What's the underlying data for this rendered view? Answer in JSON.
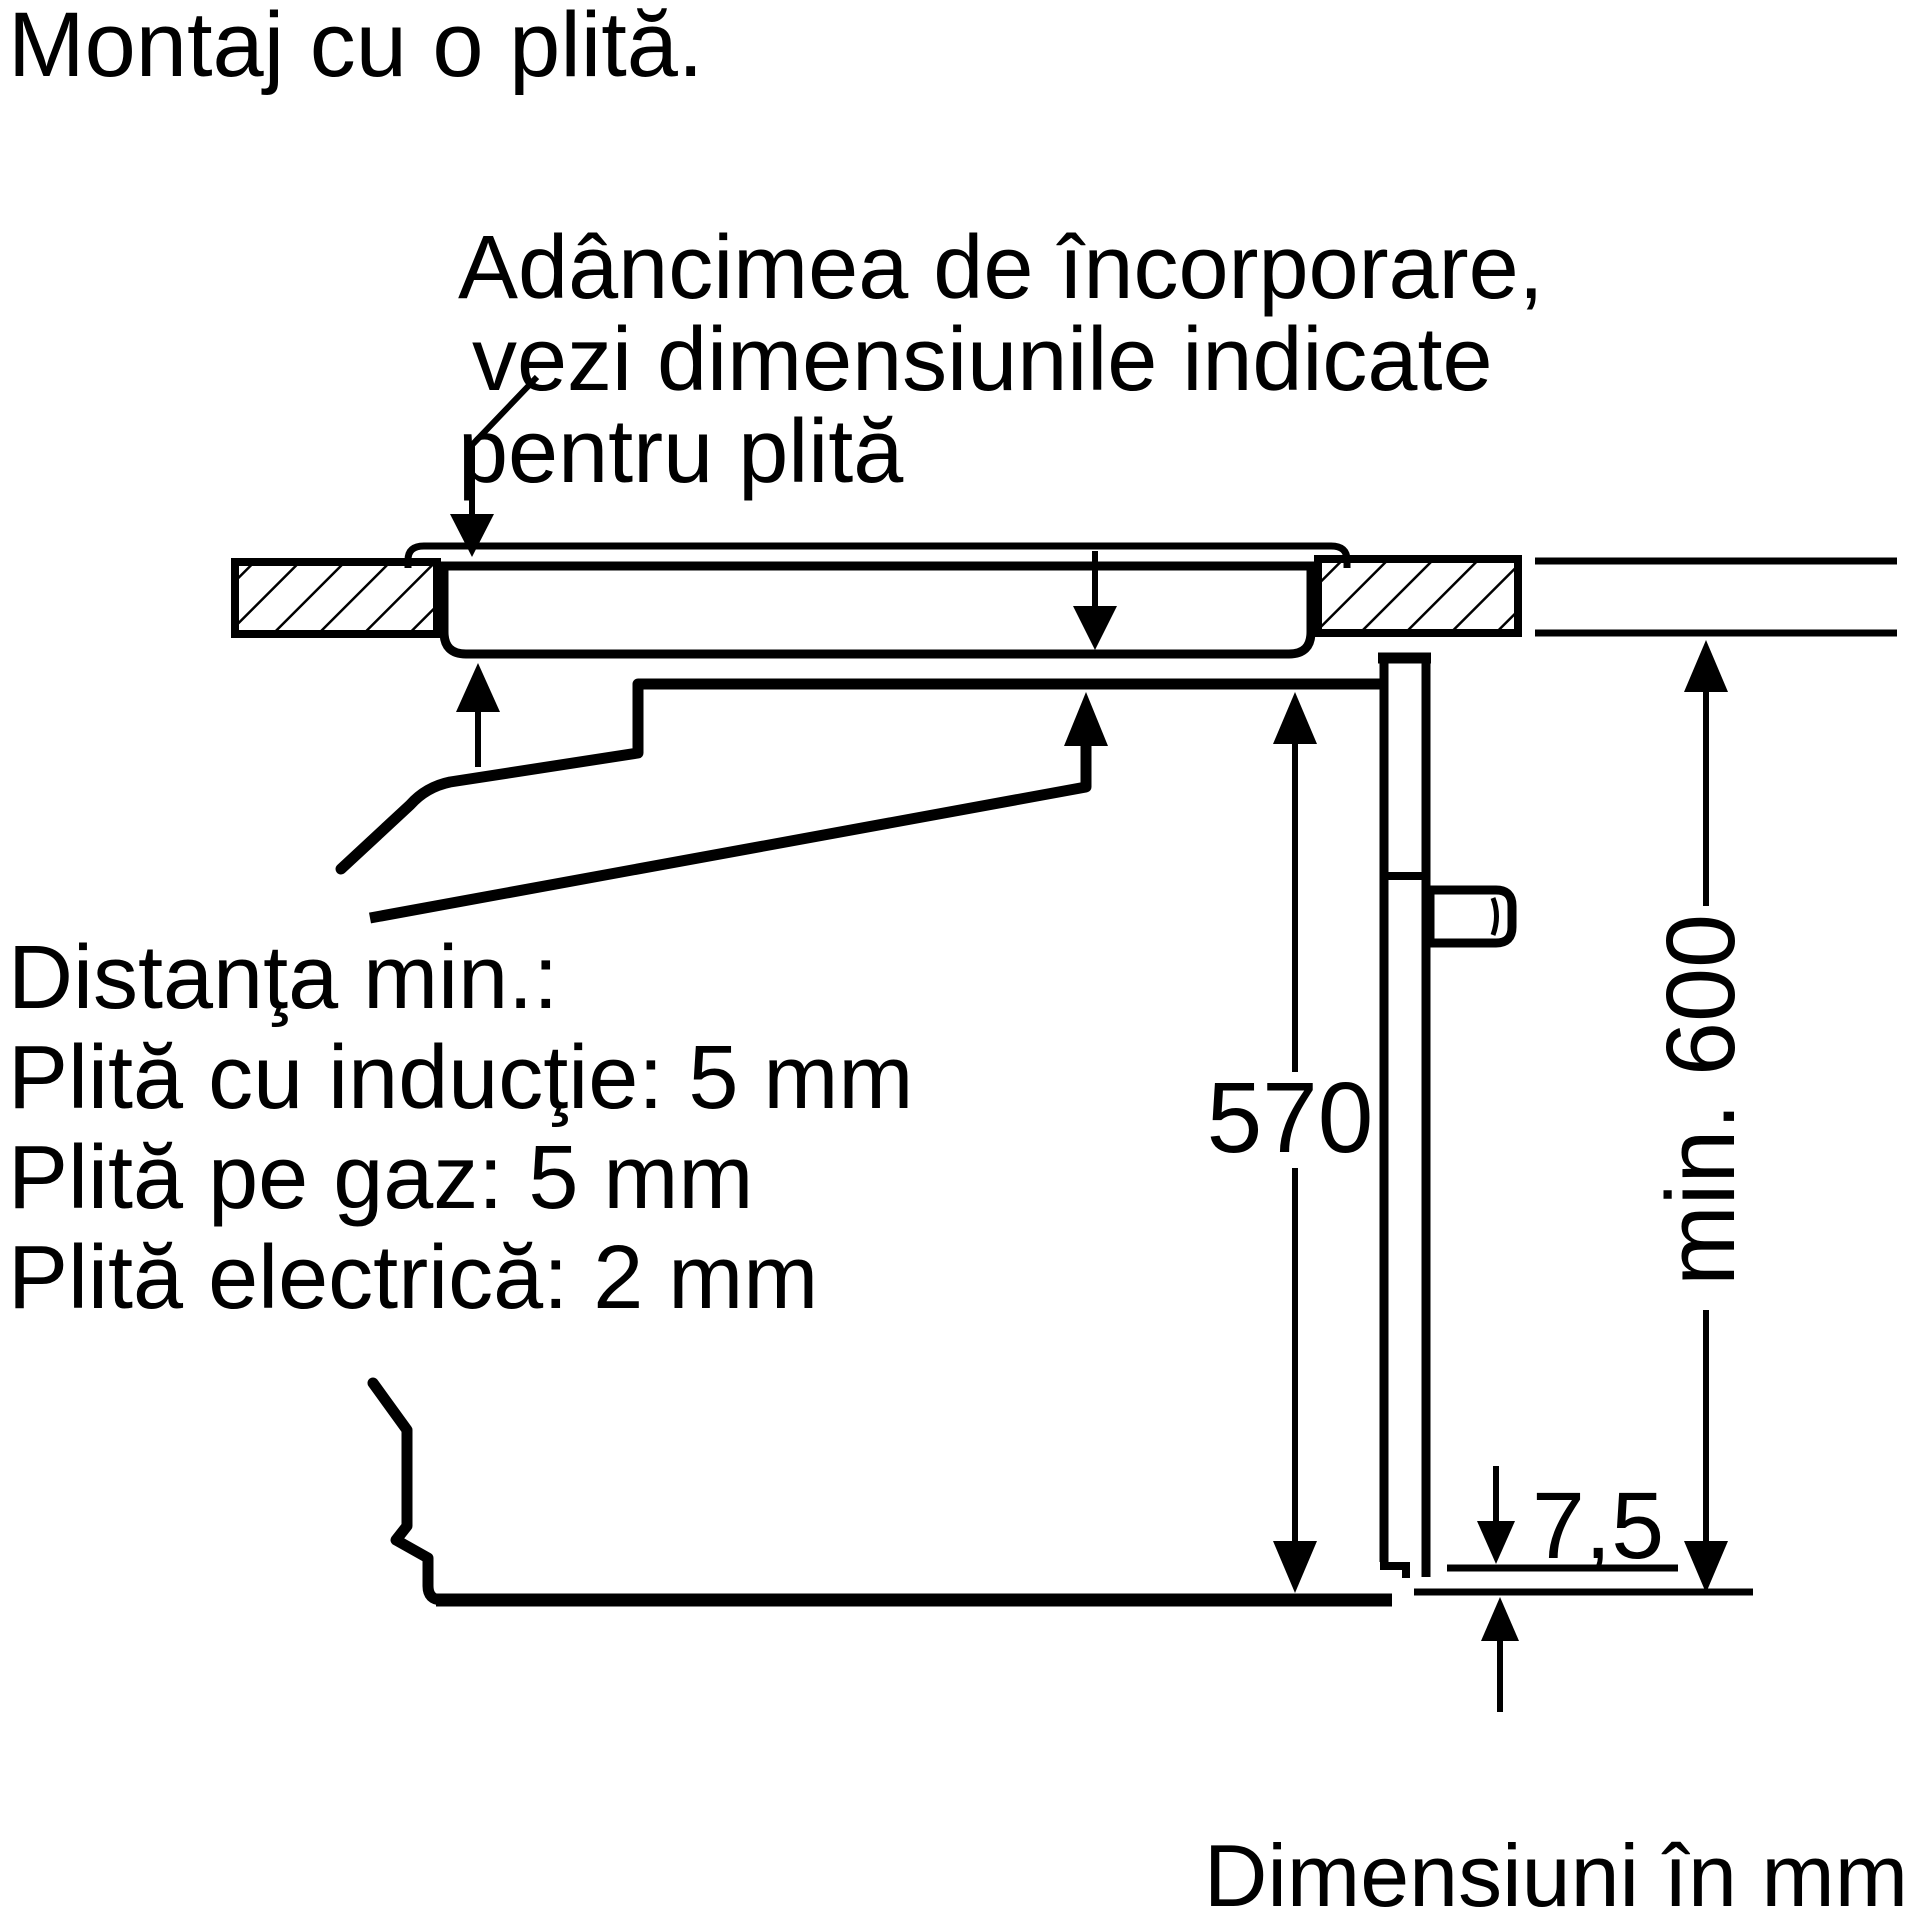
{
  "colors": {
    "ink": "#000000",
    "paper": "#ffffff"
  },
  "title": "Montaj cu o plită.",
  "callout_depth": {
    "line1": "Adâncimea de încorporare,",
    "line2": "vezi dimensiunile indicate",
    "line3": "pentru plită"
  },
  "callout_clearance": {
    "line1": "Distanţa min.:",
    "line2": "Plită cu inducţie: 5 mm",
    "line3": "Plită pe gaz: 5 mm",
    "line4": "Plită electrică: 2 mm"
  },
  "dimensions": {
    "oven_interior_height": "570",
    "min_niche_height": "min. 600",
    "rear_gap": "7,5"
  },
  "footer_note": "Dimensiuni în mm"
}
